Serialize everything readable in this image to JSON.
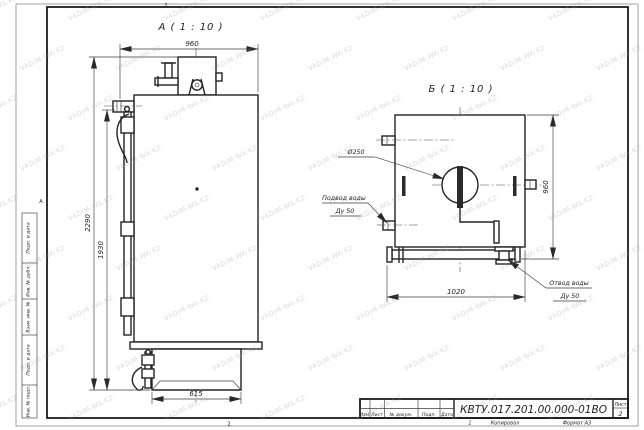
{
  "watermark": {
    "text": "VADIM-WA.KZ"
  },
  "sheet": {
    "zone_top": "2",
    "zone_bottom": "2",
    "zone_left": "А",
    "margin_stamps": [
      "Подп. и дата",
      "Инв. № дубл.",
      "Взам. инв. №",
      "Подп. и дата",
      "Инв. № подл."
    ]
  },
  "front_view": {
    "title": "А ( 1 : 10 )",
    "dim_width": "960",
    "dim_height_overall": "2290",
    "dim_height_body": "1930",
    "dim_base": "615"
  },
  "side_view": {
    "title": "Б ( 1 : 10 )",
    "dim_width": "1020",
    "dim_height": "960",
    "hatch_diameter": "Ø250",
    "inlet_label": "Подвод воды",
    "inlet_size": "Ду 50",
    "outlet_label": "Отвод воды",
    "outlet_size": "Ду 50"
  },
  "title_block": {
    "doc_number": "КВТУ.017.201.00.000-01ВО",
    "sheet_label": "Лист",
    "sheet_number": "2",
    "columns": [
      "Изм.",
      "Лист",
      "№ докум.",
      "Подп.",
      "Дата"
    ],
    "copied": "Копировал",
    "format": "Формат А3",
    "fold_mark": "1"
  }
}
